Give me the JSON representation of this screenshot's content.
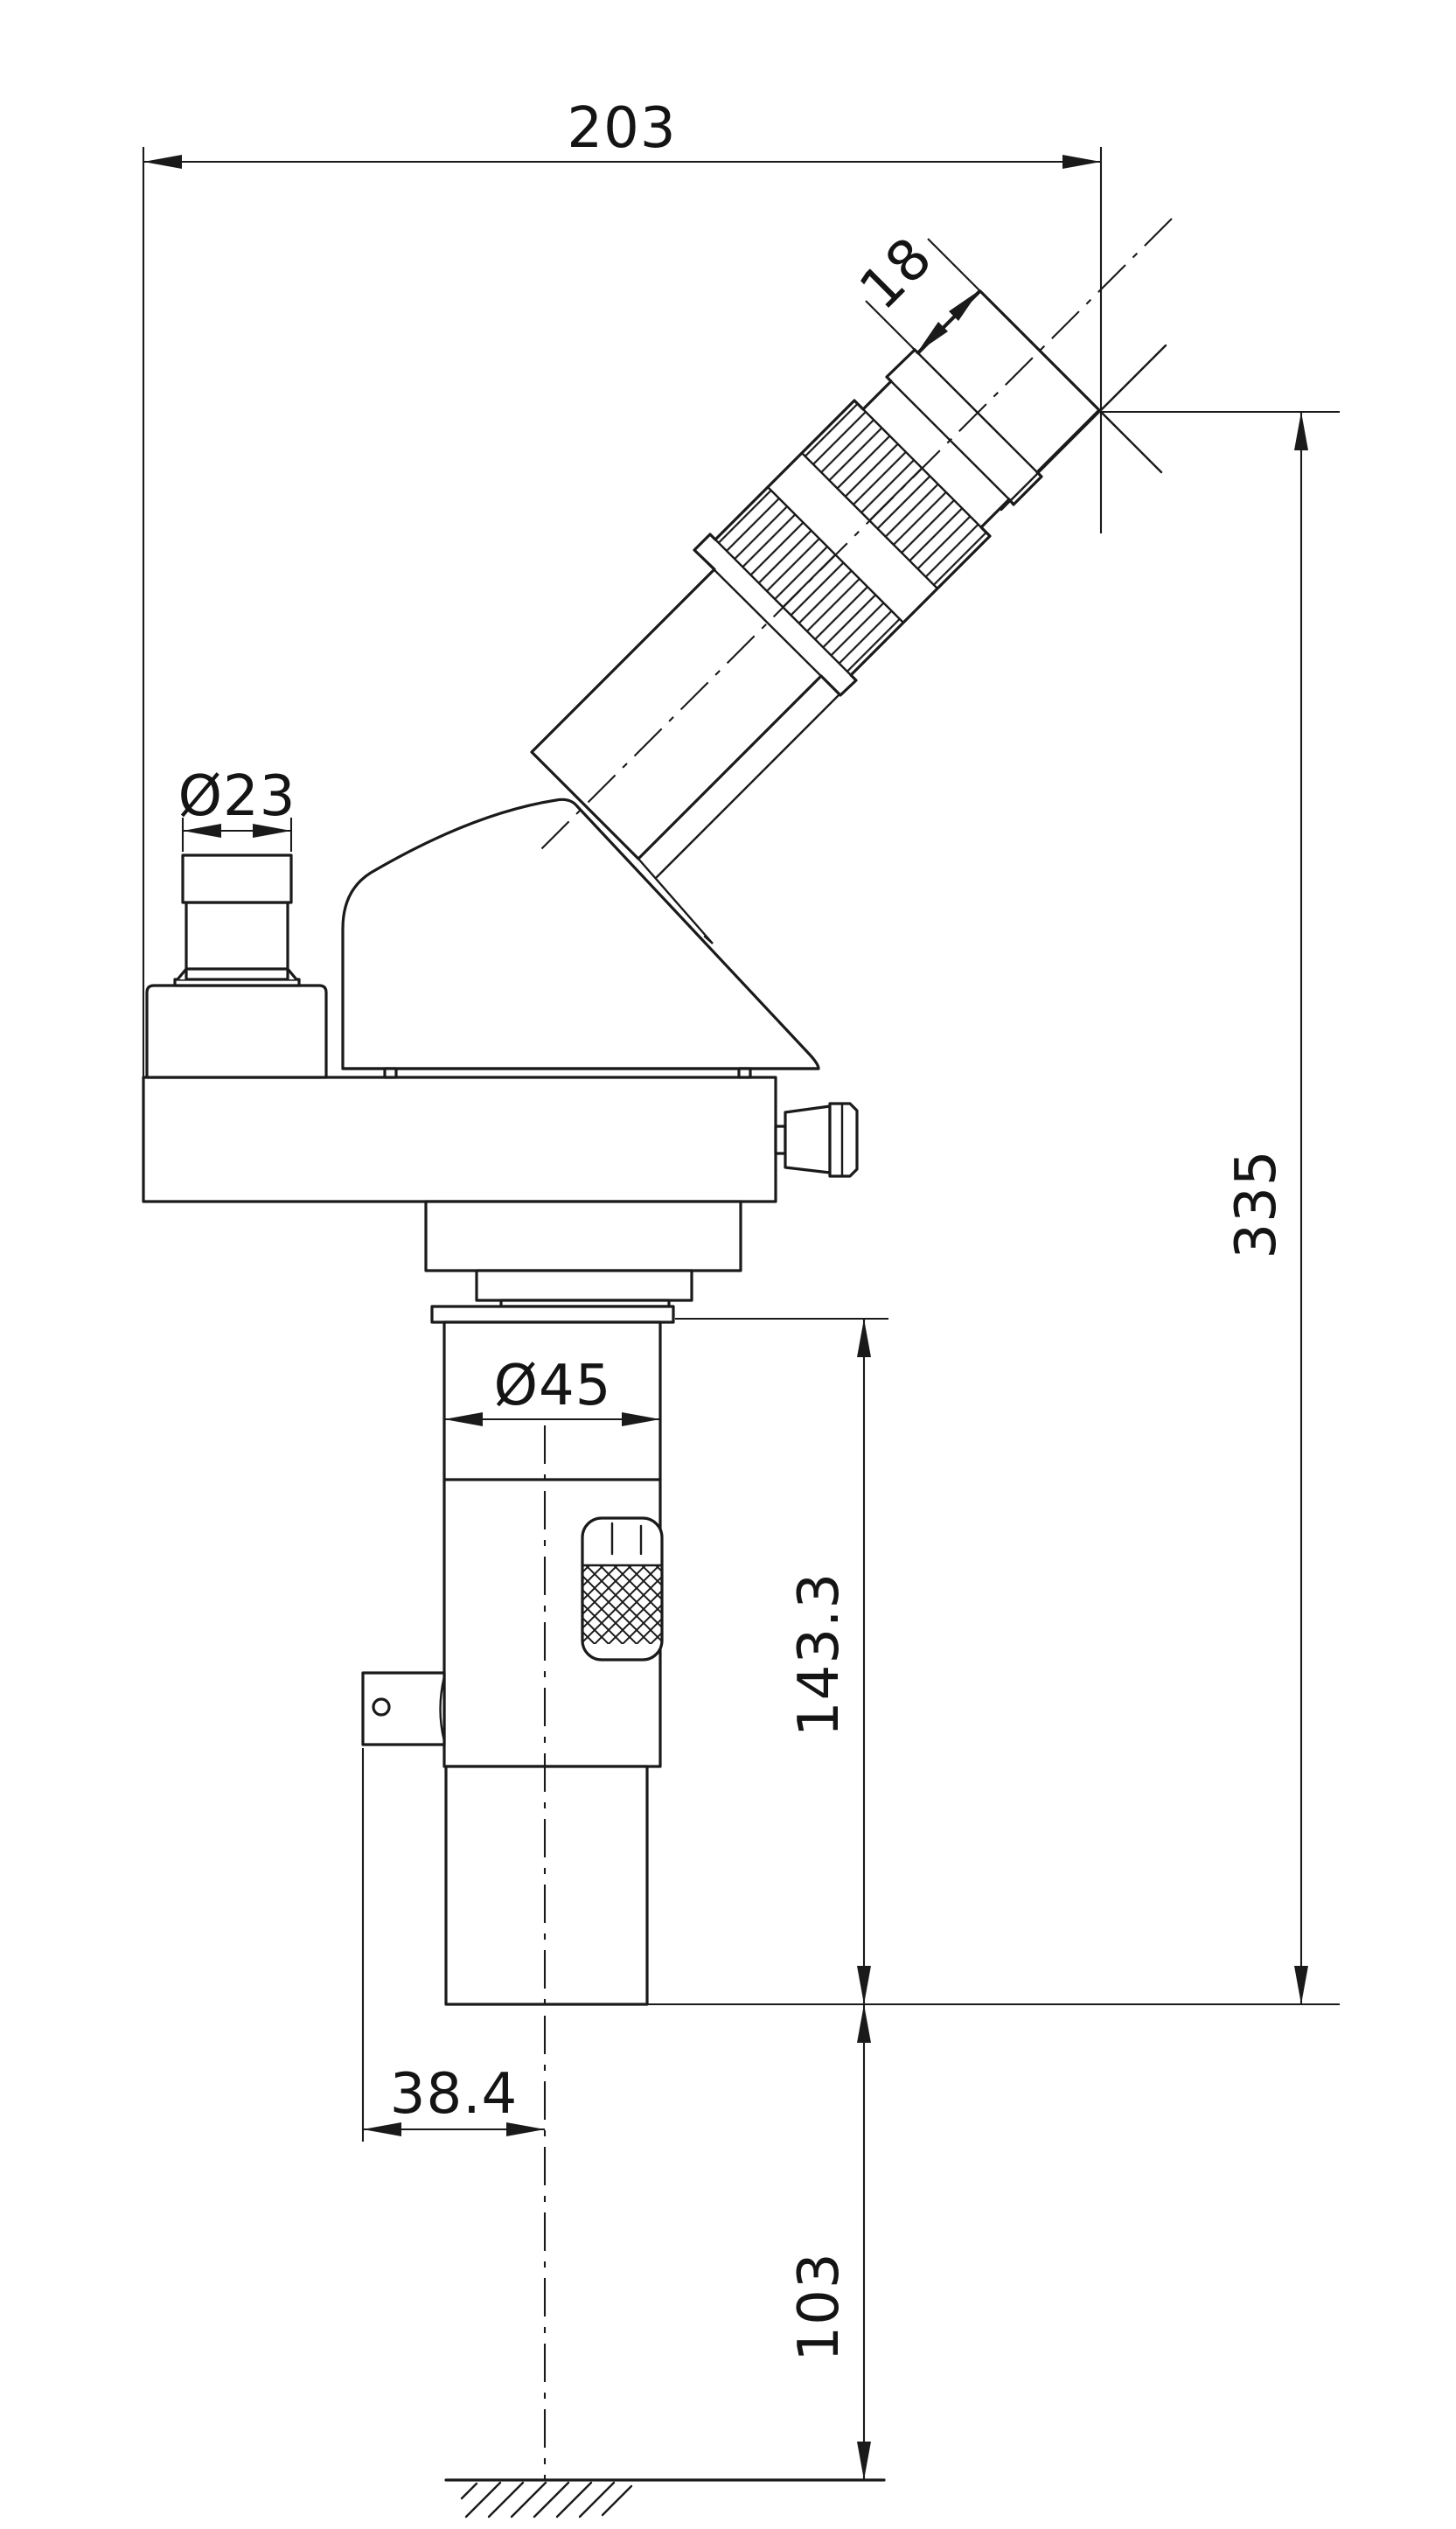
{
  "drawing": {
    "background": "#ffffff",
    "line_color": "#1a1a1a",
    "dimensions": {
      "width_total": "203",
      "eyecup_length": "18",
      "port_diameter": "Ø23",
      "height_total": "335",
      "column_diameter": "Ø45",
      "body_height": "143.3",
      "axis_offset": "38.4",
      "ground_height": "103"
    }
  }
}
